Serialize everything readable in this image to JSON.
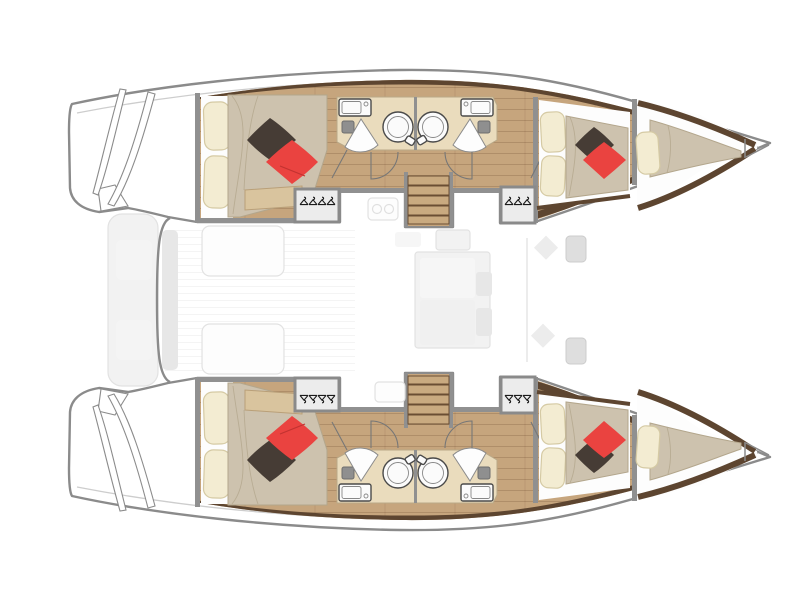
{
  "page": {
    "background": "#ffffff",
    "description": "Overhead accommodation floor plan of a 4-cabin sailing catamaran; bows to the right, twin transoms with steps to the left, ghosted cockpit / saloon / foredeck in the centre"
  },
  "colors": {
    "page-bg": "#ffffff",
    "hull-outline": "#8b8b8b",
    "deck-line": "#cdcdcd",
    "wall": "#909090",
    "wood-floor": "#c6a57d",
    "wood-trim-dark": "#5d4530",
    "bathroom-floor": "#eadcbd",
    "bath-edge": "#b9a988",
    "duvet": "#cdc2ae",
    "duvet-line": "#b3a68c",
    "pillow-cream": "#f3ecd2",
    "pillow-cream-border": "#d5caa4",
    "pillow-red": "#ea4340",
    "pillow-dark": "#463c35",
    "bench-tan": "#d9c49e",
    "stair-tread": "#c9aa80",
    "stair-edge": "#6a4e33",
    "locker-fill": "#ececec",
    "locker-border": "#8a8a8a",
    "hanger": "#1a1a1a",
    "fixture-fill": "#fbfbfb",
    "fixture-stroke": "#4a4a4a",
    "toilet-gray": "#8f8f8f",
    "ghost-fill": "#f2f2f2",
    "ghost-stroke": "#e2e2e2",
    "ghost-dark": "#e7e7e7"
  },
  "vessel": {
    "type": "catamaran",
    "view": "top-down deck plan",
    "orientation": "bows right, sterns left",
    "counts": {
      "double_cabins": 4,
      "bathrooms": 4,
      "bow_berths": 2,
      "staircases": 2,
      "wardrobes": 4,
      "transom_platforms": 2
    },
    "hulls": [
      {
        "name": "port hull (top)",
        "rooms": [
          "aft double cabin",
          "aft bathroom with round shower",
          "forward bathroom with round shower",
          "forward double cabin",
          "bow berth",
          "companionway stairs",
          "two hanging wardrobes",
          "transom swim steps"
        ]
      },
      {
        "name": "starboard hull (bottom)",
        "rooms": [
          "aft double cabin",
          "aft bathroom with round shower",
          "forward bathroom with round shower",
          "forward double cabin",
          "bow berth",
          "companionway stairs",
          "two hanging wardrobes",
          "transom swim steps"
        ]
      }
    ],
    "center_deck": [
      "aft bench between transoms (ghosted)",
      "cockpit with table (ghosted)",
      "saloon with galley and seating (ghosted)",
      "foredeck hatches (ghosted)"
    ],
    "bed_styling": "beige duvet, two cream head pillows, one dark-brown and one red accent cushion per double cabin; single cream pillow on each bow berth"
  }
}
